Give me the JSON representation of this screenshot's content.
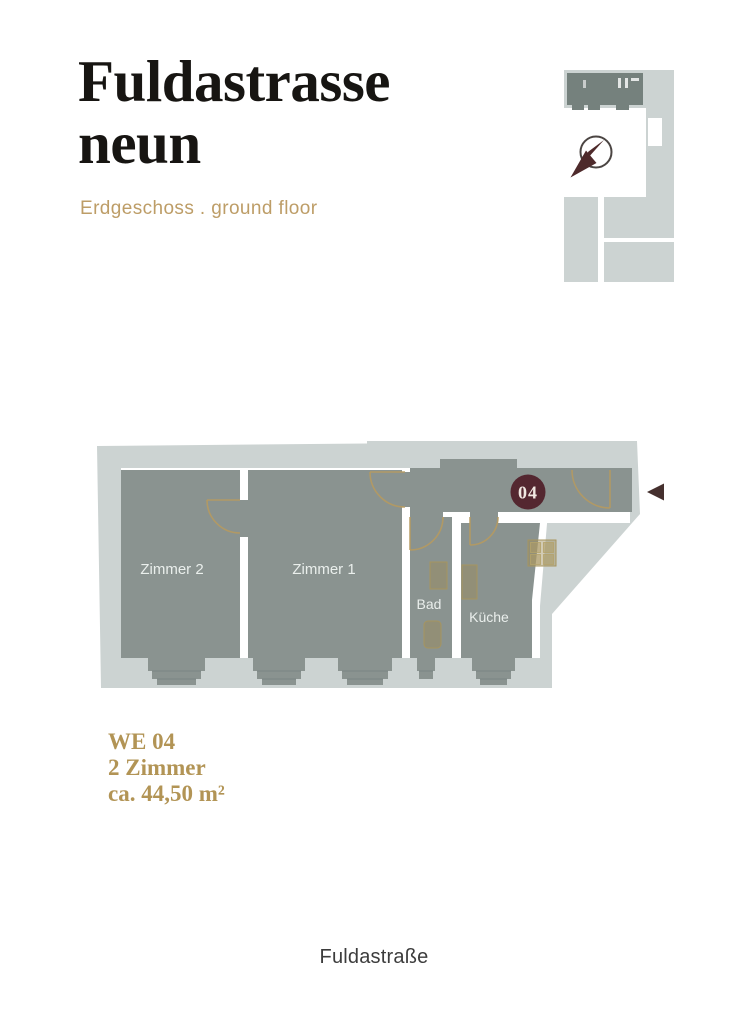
{
  "header": {
    "title_line1": "Fuldastrasse",
    "title_line2": "neun",
    "subtitle": "Erdgeschoss . ground floor"
  },
  "site_plan": {
    "description": "building-outline-site-plan",
    "icons": {
      "compass": "compass-icon"
    }
  },
  "floor_plan": {
    "rooms": [
      {
        "label": "Zimmer 2"
      },
      {
        "label": "Zimmer 1"
      },
      {
        "label": "Bad"
      },
      {
        "label": "Küche"
      }
    ],
    "unit_badge": "04",
    "icons": {
      "entrance_arrow": "entrance-arrow-icon"
    }
  },
  "unit_info": {
    "line1": "WE 04",
    "line2": "2 Zimmer",
    "line3": "ca. 44,50 m²"
  },
  "footer": {
    "street": "Fuldastraße"
  },
  "colors": {
    "wall_gray": "#CCD3D2",
    "room_fill": "#8A9390",
    "site_plan_unit": "#75817D",
    "accent_tan": "#B59A60",
    "badge_wine": "#542730",
    "title_text": "#171512"
  }
}
